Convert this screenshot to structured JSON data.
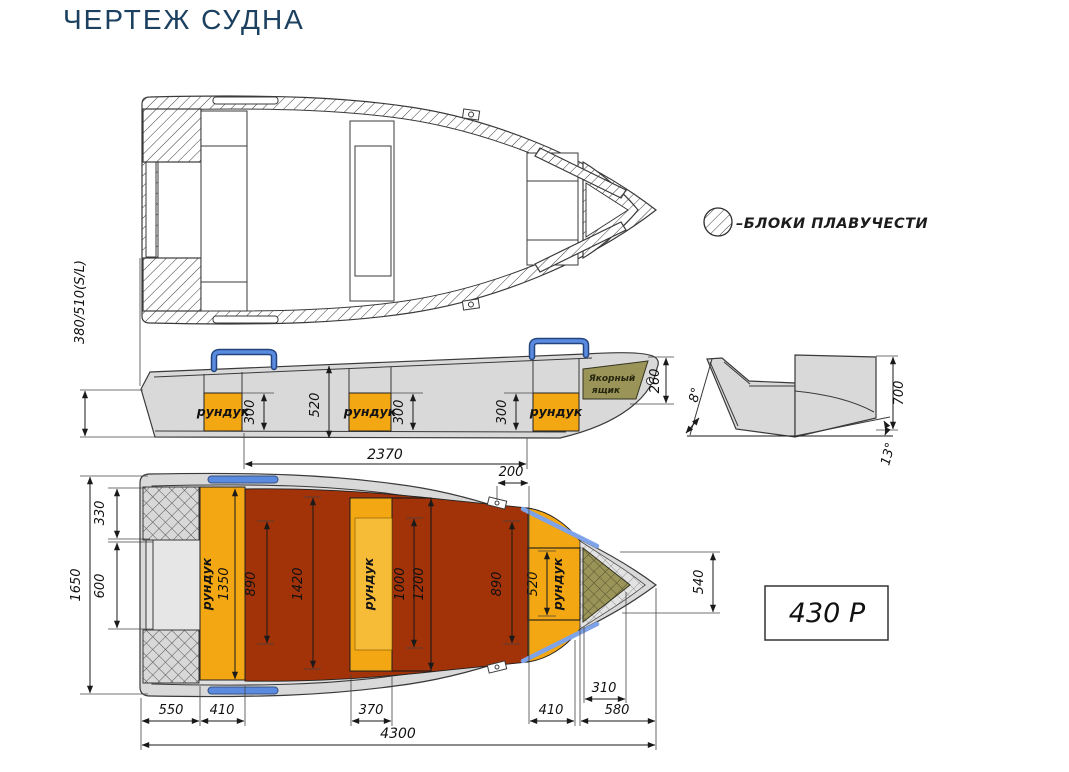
{
  "title": "ЧЕРТЕЖ СУДНА",
  "legend": {
    "buoyancy_label": "–БЛОКИ ПЛАВУЧЕСТИ"
  },
  "model_box": {
    "label": "430 Р"
  },
  "side_view": {
    "transom_height": "380/510(S/L)",
    "locker": "рундук",
    "anchor_line1": "Якорный",
    "anchor_line2": "ящик",
    "locker_depth": "300",
    "hull_depth": "520",
    "bow_box_depth": "260",
    "cockpit_length": "2370"
  },
  "transom_view": {
    "deadrise_angle": "8°",
    "transom_height": "700",
    "transom_angle": "13°"
  },
  "plan_view": {
    "locker": "рундук",
    "beam": "1650",
    "stern_block": "330",
    "stern_platform": "600",
    "stern_locker_len": "1350",
    "floor_width_stern": "890",
    "floor_width_max": "1420",
    "mid_seat_len": "1000",
    "mid_seat_outer_len": "1200",
    "floor_width_bow": "890",
    "bow_locker_len": "520",
    "bow_width": "540",
    "gunwale_step": "200",
    "stern_overhang": "550",
    "stern_locker_w": "410",
    "mid_locker_w": "370",
    "bow_locker_w": "410",
    "bow_section": "580",
    "anchor_depth": "310",
    "overall_length": "4300"
  },
  "colors": {
    "title_navy": "#1B4060",
    "hull_gray": "#D9D9D9",
    "locker_yellow": "#F3A712",
    "floor_red": "#A23208",
    "olive_khaki": "#9A9459",
    "handle_blue": "#5B8BE0",
    "rubrail_blue": "#7FA3E8"
  }
}
